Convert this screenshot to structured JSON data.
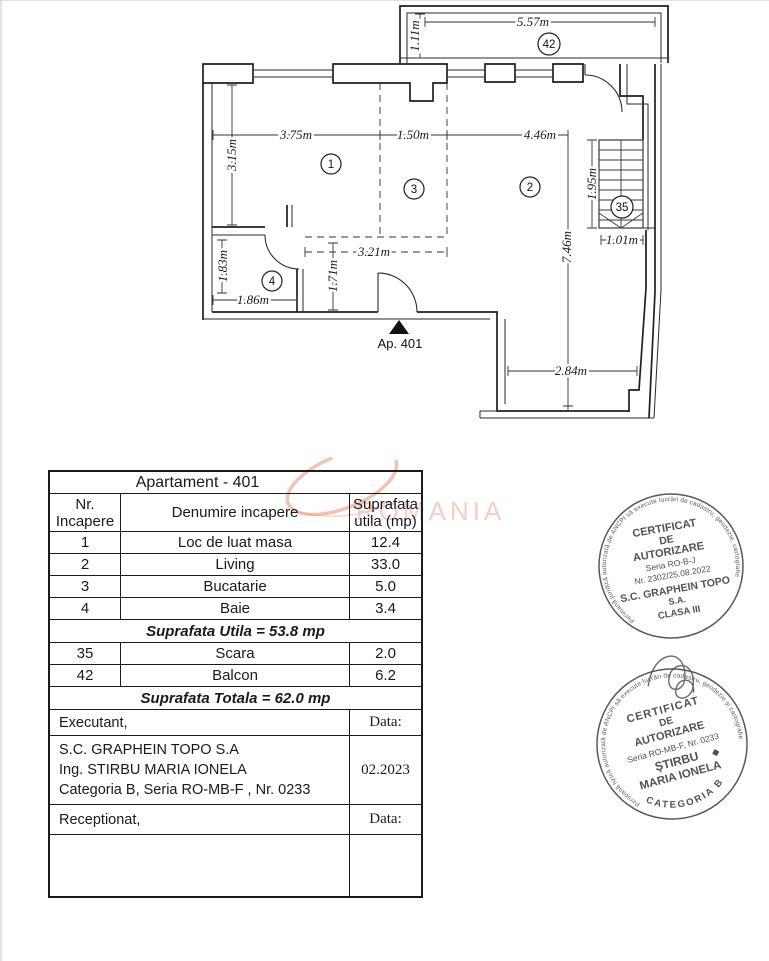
{
  "plan": {
    "entrance_label": "Ap. 401",
    "room_numbers": {
      "dining_1": "1",
      "living_2": "2",
      "kitchen_3": "3",
      "bath_4": "4",
      "stairs_35": "35",
      "balcony_42": "42"
    },
    "dimensions": {
      "balcony_width": "5.57m",
      "balcony_depth": "1.11m",
      "room1_width": "3.75m",
      "room3_width": "1.50m",
      "room2_width": "4.46m",
      "room1_height": "3.15m",
      "stair_height": "1.95m",
      "stair_width": "1.01m",
      "hall_width": "3.21m",
      "room2_height": "7.46m",
      "bath_height": "1.83m",
      "hall_height": "1.71m",
      "bath_width": "1.86m",
      "extension_width": "2.84m"
    }
  },
  "watermark": {
    "text": "ROMANIA",
    "arc_color": "#e8906a",
    "text_color": "#f6c2b2"
  },
  "table": {
    "title": "Apartament - 401",
    "header": {
      "col1_line1": "Nr.",
      "col1_line2": "Incapere",
      "col2": "Denumire incapere",
      "col3_line1": "Suprafata",
      "col3_line2": "utila (mp)"
    },
    "rows": [
      {
        "nr": "1",
        "name": "Loc de luat masa",
        "area": "12.4"
      },
      {
        "nr": "2",
        "name": "Living",
        "area": "33.0"
      },
      {
        "nr": "3",
        "name": "Bucatarie",
        "area": "5.0"
      },
      {
        "nr": "4",
        "name": "Baie",
        "area": "3.4"
      }
    ],
    "subtotal": "Suprafata Utila =  53.8 mp",
    "rows2": [
      {
        "nr": "35",
        "name": "Scara",
        "area": "2.0"
      },
      {
        "nr": "42",
        "name": "Balcon",
        "area": "6.2"
      }
    ],
    "total": "Suprafata Totala =  62.0 mp",
    "executant_label": "Executant,",
    "executant_line1": "S.C. GRAPHEIN TOPO S.A",
    "executant_line2": "Ing. STIRBU MARIA IONELA",
    "executant_line3": "Categoria B, Seria RO-MB-F , Nr. 0233",
    "data_label": "Data:",
    "data_value": "02.2023",
    "receptionat_label": "Receptionat,",
    "data_label2": "Data:"
  },
  "stamp1": {
    "ring_text": "Persoană juridică autorizată de ANCPI să execute lucrări de cadastru, geodezie, cartografie",
    "line1": "CERTIFICAT",
    "line2": "DE",
    "line3": "AUTORIZARE",
    "line4": "Seria RO-B-J",
    "line5": "Nr. 2302/25.08.2022",
    "line6": "S.C. GRAPHEIN TOPO",
    "line7": "S.A.",
    "line8": "CLASA III"
  },
  "stamp2": {
    "ring_text": "Persoană fizică autorizată de ANCPI să execute lucrări de cadastru, geodezie şi cartografie",
    "line1": "CERTIFICAT",
    "line2": "DE",
    "line3": "AUTORIZARE",
    "line4": "Seria RO-MB-F, Nr. 0233",
    "line5": "ŞTIRBU",
    "mark": "◆",
    "line6": "MARIA IONELA",
    "bottom_arc": "CATEGORIA B"
  }
}
